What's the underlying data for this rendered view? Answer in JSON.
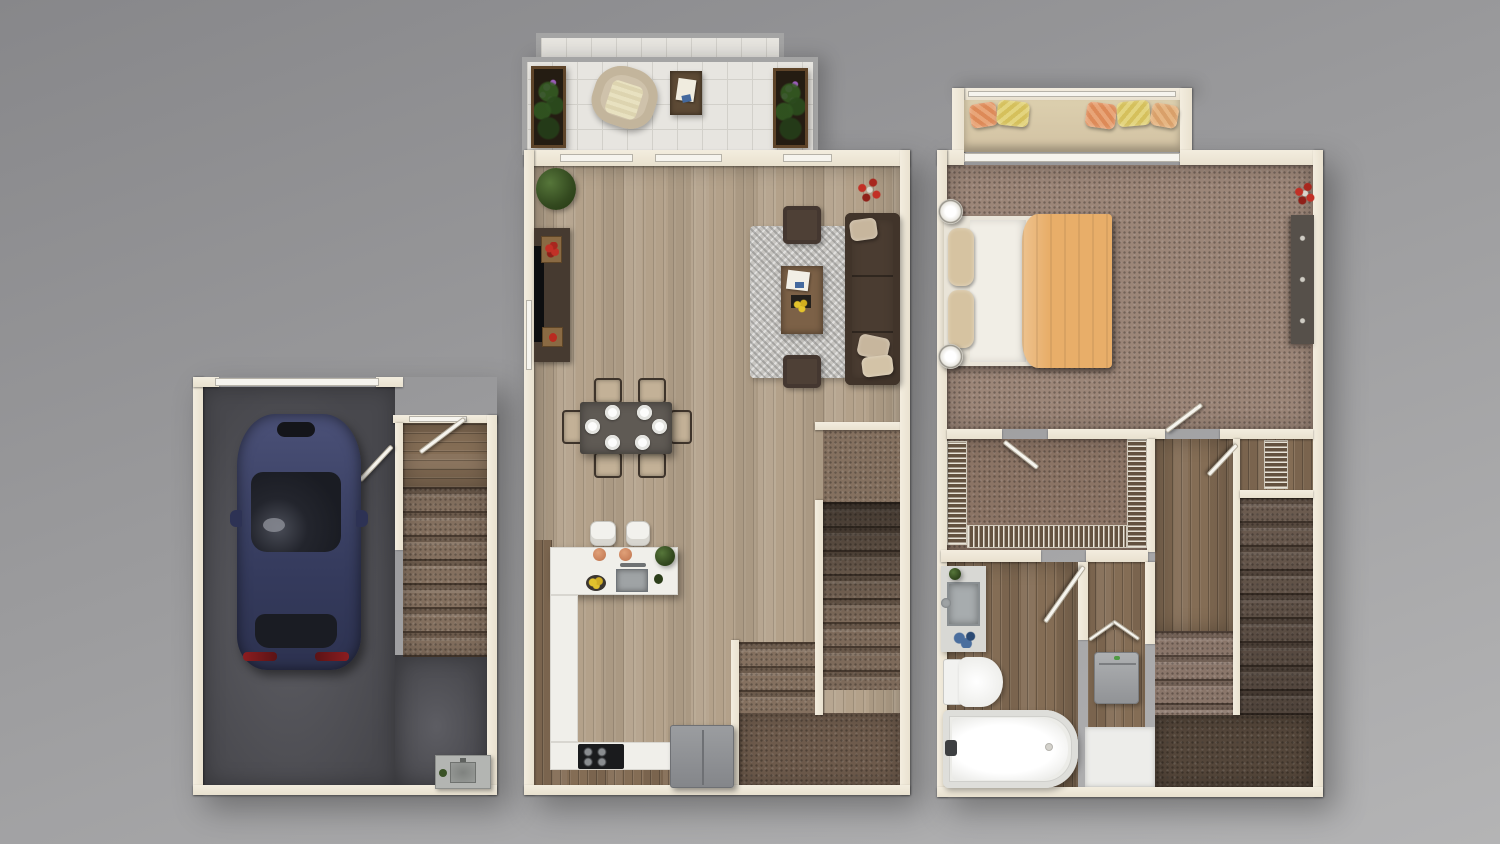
{
  "scene": {
    "kind": "3d-rendered-floor-plan",
    "view": "top-down-dollhouse",
    "background": "neutral gray studio gradient",
    "sections_left_to_right": [
      "garage-level",
      "main-living-level",
      "upper-bedroom-level"
    ]
  },
  "palette": {
    "bg_top": "#87878a",
    "bg_bottom": "#b4b4b5",
    "wall": "#e9e1cf",
    "white": "#f6f4ee",
    "tile": "#e7e5e0",
    "tile_line": "#d2d0ca",
    "garage_floor": "#48484d",
    "garage_floor_light": "#5d5d63",
    "wood_light": "#b3a18a",
    "wood_dark": "#846d55",
    "carpet_bed": "#9c8678",
    "carpet_closet": "#8b7465",
    "carpet_stair": "#84705f",
    "carpet_dark": "#54463a",
    "stair_dark": "#50433a",
    "rug": "#c7c5c1",
    "sofa": "#4a3c31",
    "pillow_tan": "#c7b69d",
    "table_wood": "#7c6147",
    "dining_table": "#5f5a54",
    "chair_tan": "#c3b197",
    "chair_dark": "#3e342b",
    "car_body": "#3e4467",
    "car_glass": "#1a1c23",
    "counter_white": "#f0efea",
    "steel": "#8f9294",
    "stove": "#1a1b1d",
    "bed_sheet": "#f1eee6",
    "blanket": "#e8ae69",
    "cushion": "#d2c2a3",
    "accent_orange": "#dd8a58",
    "accent_yellow": "#d5c05c",
    "accent_red": "#b92b20",
    "accent_purple": "#9455a8",
    "accent_blue": "#44699e",
    "plant_green": "#3a5226",
    "dresser": "#56504a",
    "washer": "#a4a6a8"
  },
  "units": [
    {
      "id": "garage-level",
      "rooms": [
        {
          "name": "garage",
          "floor": "concrete-dark-gray",
          "furniture": [
            "sedan-car-dark-blue",
            "utility-sink",
            "garage-door-top"
          ]
        },
        {
          "name": "entry-landing-and-stairs",
          "floor": "wood-dark + carpet-stairs",
          "furniture": [
            "entry-door",
            "door-to-garage",
            "staircase-8-steps"
          ]
        }
      ]
    },
    {
      "id": "main-living-level",
      "rooms": [
        {
          "name": "patio",
          "floor": "white-tile",
          "furniture": [
            "lounge-chair",
            "side-table-with-papers",
            "planter-left",
            "planter-right"
          ]
        },
        {
          "name": "living-room",
          "floor": "wood-light",
          "furniture": [
            "media-console",
            "flat-tv",
            "wood-trays",
            "potted-plant",
            "shag-rug",
            "sectional-sofa",
            "tan-pillows",
            "ottoman-upper",
            "ottoman-lower",
            "coffee-table-with-papers-and-flowers",
            "red-flower-accent"
          ]
        },
        {
          "name": "dining-area",
          "floor": "wood-light",
          "furniture": [
            "dining-table",
            "six-chairs",
            "six-place-settings"
          ]
        },
        {
          "name": "kitchen",
          "floor": "wood-light + wood-dark-walkway",
          "furniture": [
            "island-with-sink",
            "two-bar-stools",
            "canisters",
            "lemon-bowl",
            "herb-plant",
            "l-counter",
            "range-cooktop",
            "refrigerator"
          ]
        },
        {
          "name": "stairwell",
          "floor": "carpet",
          "furniture": [
            "upper-landing",
            "flight-down-8-steps",
            "lower-flight-3-steps",
            "bottom-landing"
          ]
        }
      ]
    },
    {
      "id": "upper-bedroom-level",
      "rooms": [
        {
          "name": "bedroom",
          "floor": "carpet-mauve",
          "furniture": [
            "window-seat-with-pillows",
            "double-bed-orange-blanket",
            "two-lamps",
            "dresser",
            "red-flower-accent",
            "door-to-hall"
          ]
        },
        {
          "name": "walk-in-closet",
          "floor": "carpet",
          "furniture": [
            "wire-shelving-left",
            "wire-shelving-right",
            "wire-shelving-bottom",
            "closet-door"
          ]
        },
        {
          "name": "hallway",
          "floor": "wood-dark",
          "furniture": []
        },
        {
          "name": "linen-closet",
          "floor": "wood-dark",
          "furniture": [
            "wire-shelving",
            "closet-door"
          ]
        },
        {
          "name": "bathroom",
          "floor": "wood-dark",
          "furniture": [
            "vanity-with-sink",
            "toilet",
            "bathtub",
            "bath-door",
            "blue-accessories",
            "small-plant"
          ]
        },
        {
          "name": "laundry-closet",
          "floor": "wood-dark",
          "furniture": [
            "washer",
            "bifold-door",
            "white-panel"
          ]
        },
        {
          "name": "stairwell",
          "floor": "carpet",
          "furniture": [
            "flight-down-9-steps",
            "return-flight-4-steps",
            "dark-landing"
          ]
        }
      ]
    }
  ]
}
